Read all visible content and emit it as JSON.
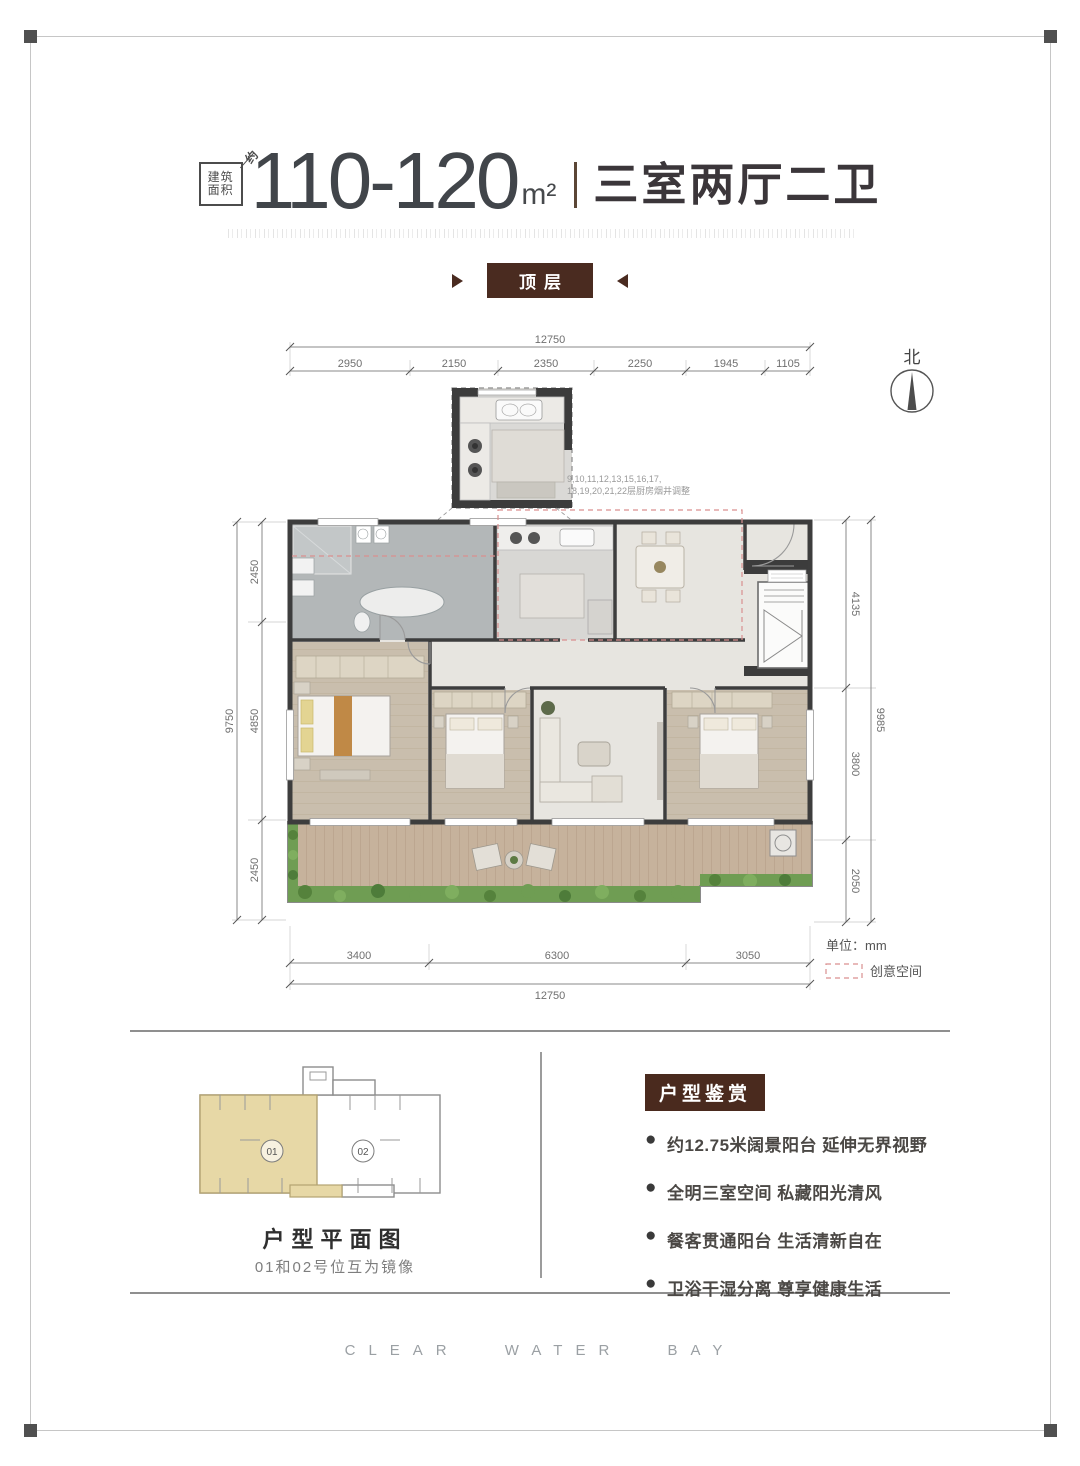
{
  "header": {
    "area_box": {
      "line1": "建筑",
      "line2": "面积",
      "diag": "约"
    },
    "area_range": "110-120",
    "area_unit": "m²",
    "layout_text": "三室两厅二卫",
    "floor_badge": "顶层"
  },
  "plan": {
    "north_label": "北",
    "inset_note_line1": "9,10,11,12,13,15,16,17,",
    "inset_note_line2": "18,19,20,21,22层厨房烟井调整",
    "dims": {
      "top_total": "12750",
      "top_segments": [
        "2950",
        "2150",
        "2350",
        "2250",
        "1945",
        "1105"
      ],
      "left_total": "9750",
      "left_segments": [
        "2450",
        "4850",
        "2450"
      ],
      "right_total": "9985",
      "right_segments": [
        "4135",
        "3800",
        "2050"
      ],
      "bottom_segments": [
        "3400",
        "6300",
        "3050"
      ],
      "bottom_total": "12750"
    },
    "legend": {
      "unit_label": "单位：mm",
      "creative_label": "创意空间"
    }
  },
  "keyplan": {
    "unit01_label": "01",
    "unit02_label": "02",
    "title": "户型平面图",
    "subtitle": "01和02号位互为镜像"
  },
  "features": {
    "title": "户型鉴赏",
    "items": [
      "约12.75米阔景阳台 延伸无界视野",
      "全明三室空间 私藏阳光清风",
      "餐客贯通阳台 生活清新自在",
      "卫浴干湿分离 尊享健康生活"
    ]
  },
  "footer": {
    "brand": "CLEAR WATER BAY"
  },
  "colors": {
    "accent_brown": "#4a2a1e",
    "badge_brown": "#4a2b20",
    "unit01_fill": "#e7d8a6",
    "creative_dash": "#d98f8f"
  }
}
